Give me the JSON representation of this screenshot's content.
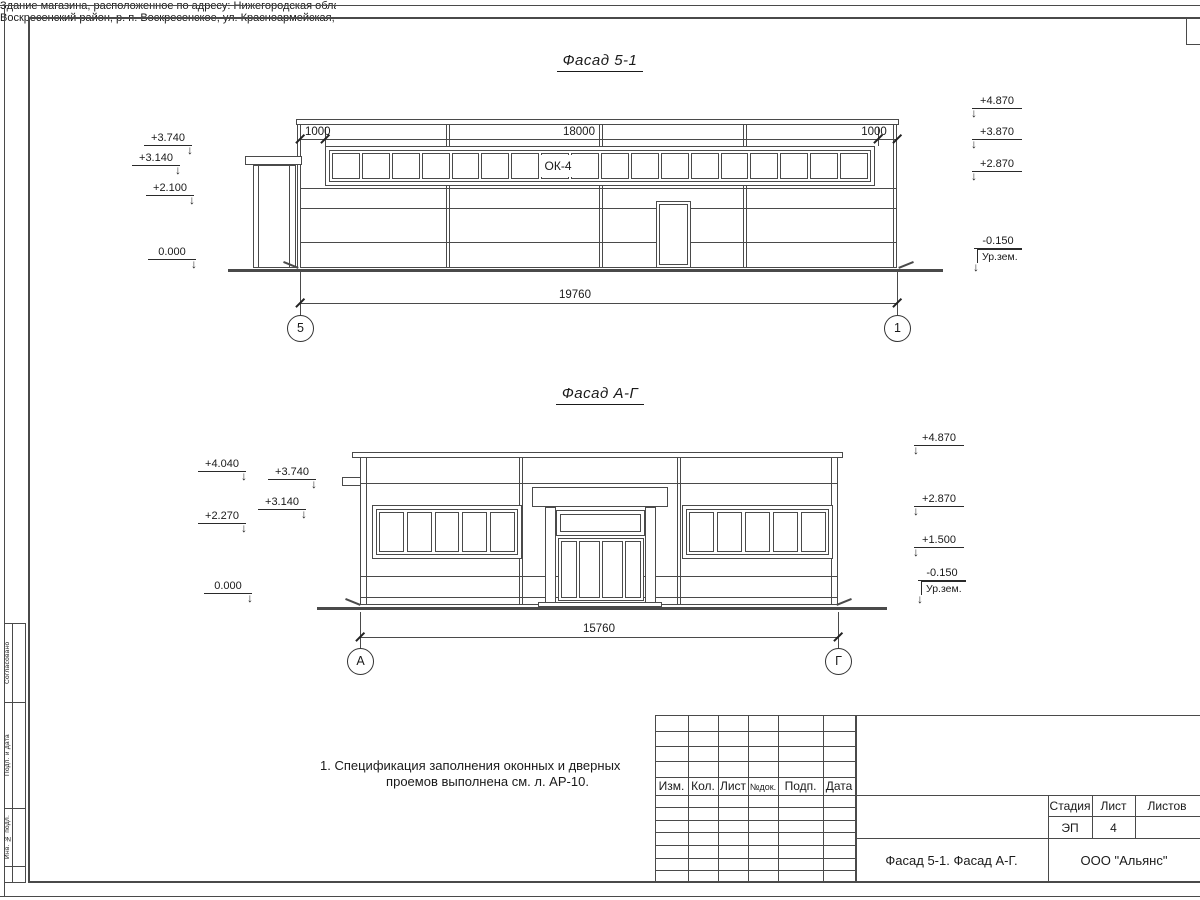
{
  "sheet": {
    "facade1": {
      "title": "Фасад 5-1",
      "window_band_label": "ОК-4",
      "window_band_panes": 18,
      "dim_segments": [
        "1000",
        "18000",
        "1000"
      ],
      "dim_total": "19760",
      "axis_left": "5",
      "axis_right": "1",
      "elev_left": [
        "+3.740",
        "+3.140",
        "+2.100",
        "0.000"
      ],
      "elev_right": [
        "+4.870",
        "+3.870",
        "+2.870",
        "-0.150"
      ],
      "ground_label": "Ур.зем."
    },
    "facade2": {
      "title": "Фасад А-Г",
      "window_panes": 5,
      "door_panels": 4,
      "dim_total": "15760",
      "axis_left": "А",
      "axis_right": "Г",
      "elev_left": [
        "+4.040",
        "+2.270",
        "0.000"
      ],
      "elev_left_inner": [
        "+3.740",
        "+3.140"
      ],
      "elev_right": [
        "+4.870",
        "+2.870",
        "+1.500",
        "-0.150"
      ],
      "ground_label": "Ур.зем."
    },
    "note": {
      "line1": "1. Спецификация заполнения оконных и дверных",
      "line2": "проемов выполнена см. л. АР-10."
    },
    "titleblock": {
      "columns": [
        "Изм.",
        "Кол.",
        "Лист",
        "№док.",
        "Подп.",
        "Дата"
      ],
      "project_line1": "Здание магазина, расположенное по адресу: Нижегородская область,",
      "project_line2": "Воскресенский район, р. п. Воскресенское, ул. Красноармейская, д. 1",
      "stage_label": "Стадия",
      "sheet_label": "Лист",
      "sheets_label": "Листов",
      "stage_value": "ЭП",
      "sheet_value": "4",
      "drawing_title": "Фасад 5-1. Фасад А-Г.",
      "company": "ООО \"Альянс\""
    },
    "side_stamp": {
      "labels": [
        "Согласовано",
        "Подп. и дата",
        "Инв. № подл."
      ]
    }
  }
}
